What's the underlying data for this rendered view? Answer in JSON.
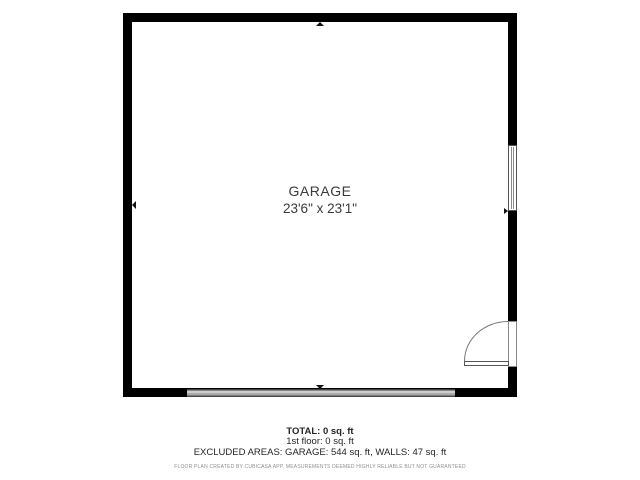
{
  "floorplan": {
    "room": {
      "name": "GARAGE",
      "dimensions": "23'6\" x 23'1\""
    },
    "symbols": [
      {
        "name": "window-symbol",
        "wall": "right"
      },
      {
        "name": "door-symbol",
        "wall": "right",
        "swing": "inward"
      },
      {
        "name": "garage-door-symbol",
        "wall": "bottom"
      }
    ]
  },
  "summary": {
    "total": "TOTAL: 0 sq. ft",
    "first_floor": "1st floor: 0 sq. ft",
    "excluded": "EXCLUDED AREAS: GARAGE: 544 sq. ft, WALLS: 47 sq. ft",
    "disclaimer": "FLOOR PLAN CREATED BY CUBICASA APP. MEASUREMENTS DEEMED HIGHLY RELIABLE BUT NOT GUARANTEED"
  },
  "colors": {
    "background": "#ffffff",
    "wall": "#000000",
    "symbol_outline": "#555555",
    "garage_door_fill": "#c8c8c8",
    "garage_door_edge": "#424242",
    "text_primary": "#3a3a3a",
    "disclaimer_text": "#8f8f8f"
  }
}
